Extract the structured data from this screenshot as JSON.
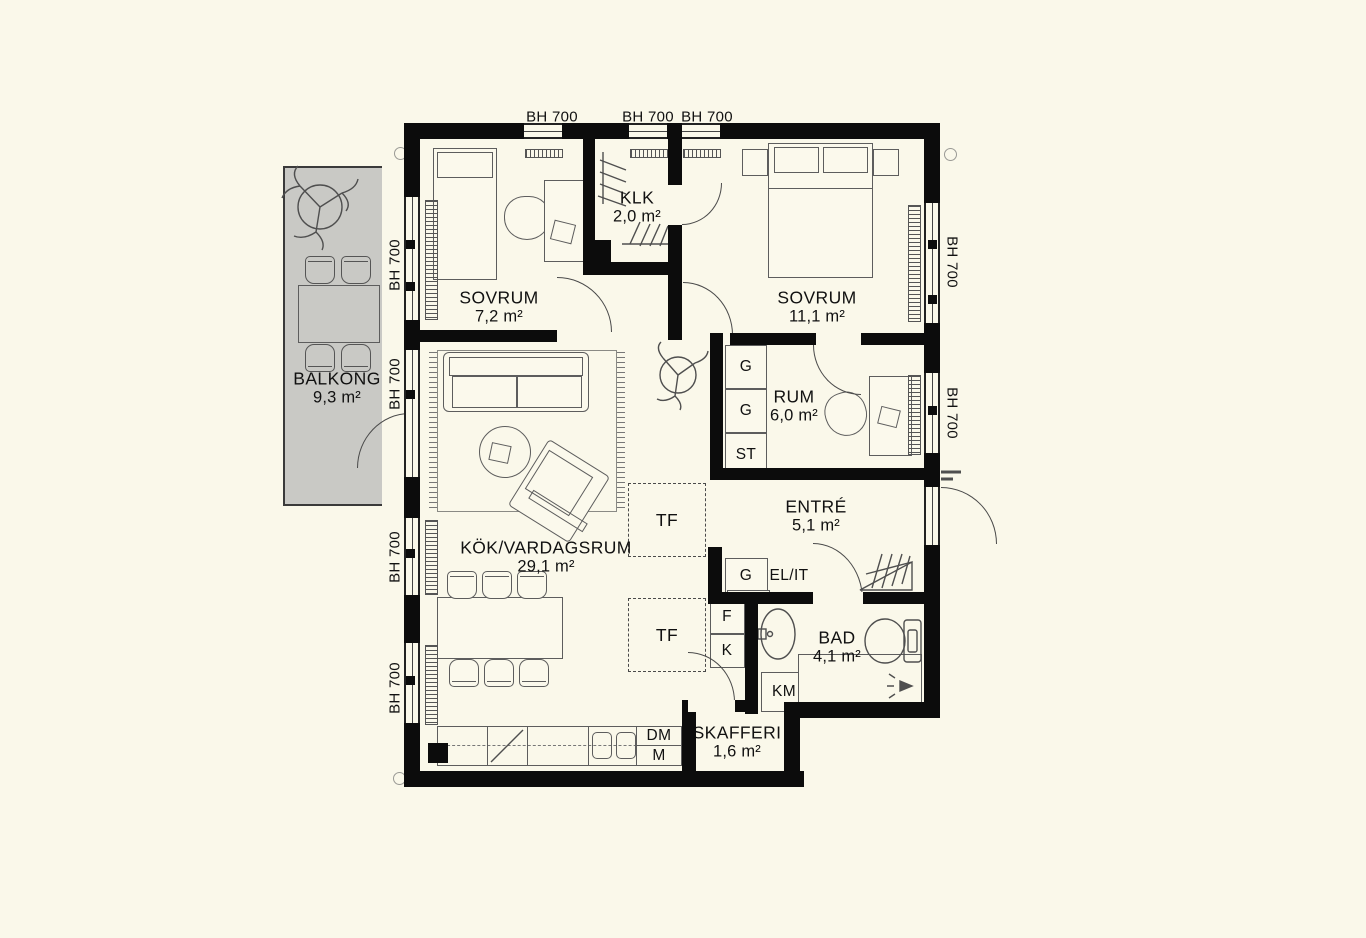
{
  "rooms": {
    "balkong": {
      "name": "BALKONG",
      "area": "9,3 m²"
    },
    "sovrum1": {
      "name": "SOVRUM",
      "area": "7,2 m²"
    },
    "klk": {
      "name": "KLK",
      "area": "2,0 m²"
    },
    "sovrum2": {
      "name": "SOVRUM",
      "area": "11,1 m²"
    },
    "rum": {
      "name": "RUM",
      "area": "6,0 m²"
    },
    "entre": {
      "name": "ENTRÉ",
      "area": "5,1 m²"
    },
    "kok": {
      "name": "KÖK/VARDAGSRUM",
      "area": "29,1 m²"
    },
    "bad": {
      "name": "BAD",
      "area": "4,1 m²"
    },
    "skafferi": {
      "name": "SKAFFERI",
      "area": "1,6 m²"
    }
  },
  "fixtures": {
    "wardrobe": "G",
    "cleaning_cabinet": "ST",
    "freezer": "F",
    "fridge": "K",
    "washing_machine": "KM",
    "dishwasher": "DM",
    "micro": "M",
    "heating_shaft": "TF",
    "el_it": "EL/IT"
  },
  "window_head_label": "BH 700",
  "colors": {
    "background": "#faf8ea",
    "wall": "#0c0c0c",
    "balcony_slab": "#c9c9c5",
    "furniture_line": "#5d5d5d"
  }
}
